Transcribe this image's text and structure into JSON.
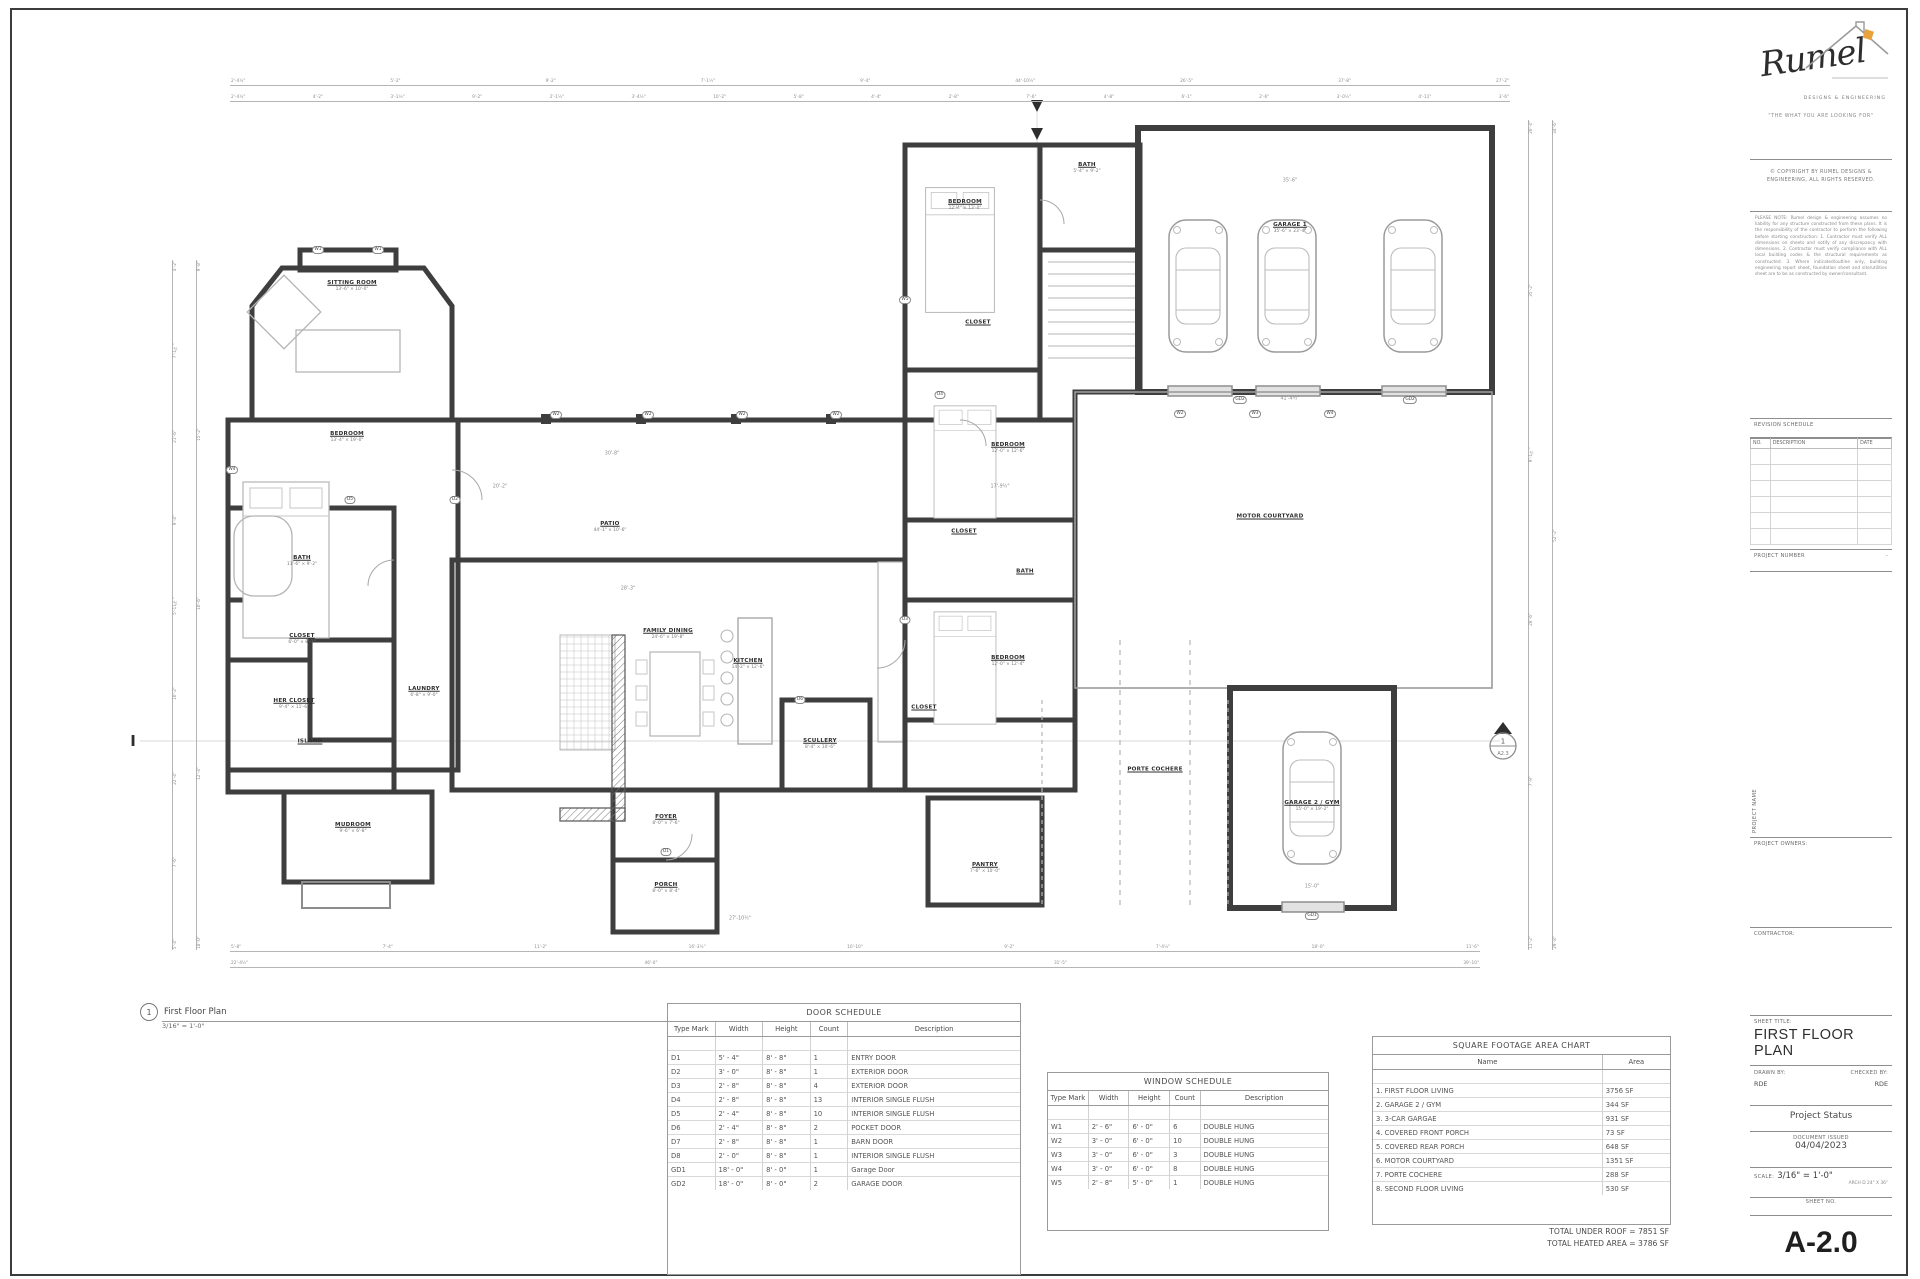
{
  "callout": {
    "number": "1",
    "title": "First Floor Plan",
    "scale": "3/16\" = 1'-0\""
  },
  "plan": {
    "room_labels": [
      {
        "n": "SITTING ROOM",
        "d": "13'-6\" × 10'-0\"",
        "x": 352,
        "y": 286
      },
      {
        "n": "BEDROOM",
        "d": "13'-4\" × 19'-0\"",
        "x": 347,
        "y": 437
      },
      {
        "n": "BATH",
        "d": "11'-6\" × 9'-2\"",
        "x": 302,
        "y": 561
      },
      {
        "n": "CLOSET",
        "d": "6'-0\" × 8'-1\"",
        "x": 302,
        "y": 639
      },
      {
        "n": "HER CLOSET",
        "d": "9'-4\" × 11'-6\"",
        "x": 294,
        "y": 704
      },
      {
        "n": "ISLAND",
        "d": "",
        "x": 310,
        "y": 742
      },
      {
        "n": "LAUNDRY",
        "d": "6'-8\" × 9'-0\"",
        "x": 424,
        "y": 692
      },
      {
        "n": "MUDROOM",
        "d": "9'-6\" × 6'-8\"",
        "x": 353,
        "y": 828
      },
      {
        "n": "PATIO",
        "d": "44'-1\" × 10'-6\"",
        "x": 610,
        "y": 527
      },
      {
        "n": "FAMILY DINING",
        "d": "24'-6\" × 19'-8\"",
        "x": 668,
        "y": 634
      },
      {
        "n": "KITCHEN",
        "d": "14'-2\" × 12'-6\"",
        "x": 748,
        "y": 664
      },
      {
        "n": "SCULLERY",
        "d": "8'-4\" × 10'-6\"",
        "x": 820,
        "y": 744
      },
      {
        "n": "FOYER",
        "d": "8'-0\" × 7'-6\"",
        "x": 666,
        "y": 820
      },
      {
        "n": "PORCH",
        "d": "8'-0\" × 8'-4\"",
        "x": 666,
        "y": 888
      },
      {
        "n": "BEDROOM",
        "d": "12'-4\" × 13'-0\"",
        "x": 965,
        "y": 205
      },
      {
        "n": "BATH",
        "d": "5'-4\" × 9'-2\"",
        "x": 1087,
        "y": 168
      },
      {
        "n": "CLOSET",
        "d": "",
        "x": 978,
        "y": 323
      },
      {
        "n": "BEDROOM",
        "d": "12'-0\" × 12'-6\"",
        "x": 1008,
        "y": 448
      },
      {
        "n": "CLOSET",
        "d": "",
        "x": 964,
        "y": 532
      },
      {
        "n": "BATH",
        "d": "",
        "x": 1025,
        "y": 572
      },
      {
        "n": "BEDROOM",
        "d": "12'-0\" × 12'-4\"",
        "x": 1008,
        "y": 661
      },
      {
        "n": "CLOSET",
        "d": "",
        "x": 924,
        "y": 708
      },
      {
        "n": "PANTRY",
        "d": "7'-6\" × 10'-0\"",
        "x": 985,
        "y": 868
      },
      {
        "n": "GARAGE 1",
        "d": "35'-6\" × 23'-4\"",
        "x": 1290,
        "y": 228
      },
      {
        "n": "MOTOR COURTYARD",
        "d": "",
        "x": 1270,
        "y": 517
      },
      {
        "n": "PORTE COCHERE",
        "d": "",
        "x": 1155,
        "y": 770
      },
      {
        "n": "GARAGE 2 / GYM",
        "d": "15'-0\" × 19'-2\"",
        "x": 1312,
        "y": 806
      }
    ],
    "tags": [
      {
        "t": "W1",
        "x": 318,
        "y": 250
      },
      {
        "t": "W1",
        "x": 378,
        "y": 250
      },
      {
        "t": "W2",
        "x": 556,
        "y": 415
      },
      {
        "t": "W2",
        "x": 648,
        "y": 415
      },
      {
        "t": "W2",
        "x": 742,
        "y": 415
      },
      {
        "t": "W2",
        "x": 836,
        "y": 415
      },
      {
        "t": "W2",
        "x": 1180,
        "y": 414
      },
      {
        "t": "W3",
        "x": 1255,
        "y": 414
      },
      {
        "t": "W4",
        "x": 1330,
        "y": 414
      },
      {
        "t": "W4",
        "x": 232,
        "y": 470
      },
      {
        "t": "W5",
        "x": 905,
        "y": 300
      },
      {
        "t": "D1",
        "x": 666,
        "y": 852
      },
      {
        "t": "D2",
        "x": 455,
        "y": 500
      },
      {
        "t": "D3",
        "x": 905,
        "y": 620
      },
      {
        "t": "D4",
        "x": 940,
        "y": 395
      },
      {
        "t": "D5",
        "x": 350,
        "y": 500
      },
      {
        "t": "D6",
        "x": 800,
        "y": 700
      },
      {
        "t": "GD2",
        "x": 1240,
        "y": 400
      },
      {
        "t": "GD2",
        "x": 1410,
        "y": 400
      },
      {
        "t": "GD1",
        "x": 1312,
        "y": 916
      },
      {
        "t": "35'-6\"",
        "x": 1290,
        "y": 182,
        "plain": true
      },
      {
        "t": "41'-4½\"",
        "x": 1290,
        "y": 400,
        "plain": true
      },
      {
        "t": "28'-3\"",
        "x": 628,
        "y": 590,
        "plain": true
      },
      {
        "t": "27'-10½\"",
        "x": 740,
        "y": 920,
        "plain": true
      },
      {
        "t": "15'-0\"",
        "x": 1312,
        "y": 888,
        "plain": true
      },
      {
        "t": "30'-8\"",
        "x": 612,
        "y": 455,
        "plain": true
      },
      {
        "t": "17'-9½\"",
        "x": 1000,
        "y": 488,
        "plain": true
      },
      {
        "t": "20'-2\"",
        "x": 500,
        "y": 488,
        "plain": true
      }
    ],
    "dims": {
      "top1": [
        "2'-4½\"",
        "5'-2\"",
        "9'-2\"",
        "7'-1½\"",
        "9'-4\"",
        "44'-10½\"",
        "26'-5\"",
        "37'-8\"",
        "27'-2\""
      ],
      "top2": [
        "2'-4½\"",
        "4'-2\"",
        "3'-1¼\"",
        "9'-2\"",
        "2'-1½\"",
        "3'-4½\"",
        "10'-2\"",
        "5'-8\"",
        "4'-4\"",
        "2'-8\"",
        "7'-6\"",
        "4'-8\"",
        "6'-1\"",
        "2'-6\"",
        "3'-0½\"",
        "4'-11\"",
        "3'-6\""
      ],
      "left1": [
        "4'-2\"",
        "7'-1½\"",
        "21'-6\"",
        "9'-4\"",
        "5'-11⅞\"",
        "10'-2\"",
        "22'-4\"",
        "7'-6\"",
        "5'-4\""
      ],
      "left2": [
        "9'-8\"",
        "15'-2\"",
        "10'-6\"",
        "12'-4\"",
        "18'-0\""
      ],
      "bottom1": [
        "5'-8\"",
        "7'-4\"",
        "11'-2\"",
        "16'-3½\"",
        "10'-10\"",
        "9'-2\"",
        "7'-4½\"",
        "18'-0\"",
        "11'-6\""
      ],
      "bottom2": [
        "22'-4½\"",
        "46'-0\"",
        "31'-5\"",
        "39'-10\""
      ],
      "right1": [
        "20'-4\"",
        "35'-2\"",
        "9'-1½\"",
        "28'-6\"",
        "7'-9\"",
        "11'-2\""
      ],
      "right2": [
        "34'-6\"",
        "52'-2\"",
        "29'-8\""
      ]
    },
    "markers": {
      "section_left": "I",
      "north_label": "A2.3"
    }
  },
  "tables": {
    "door_schedule": {
      "title": "DOOR SCHEDULE",
      "headers": [
        "Type Mark",
        "Width",
        "Height",
        "Count",
        "Description"
      ],
      "rows": [
        [
          "D1",
          "5' - 4\"",
          "8' - 8\"",
          "1",
          "ENTRY DOOR"
        ],
        [
          "D2",
          "3' - 0\"",
          "8' - 8\"",
          "1",
          "EXTERIOR DOOR"
        ],
        [
          "D3",
          "2' - 8\"",
          "8' - 8\"",
          "4",
          "EXTERIOR DOOR"
        ],
        [
          "D4",
          "2' - 8\"",
          "8' - 8\"",
          "13",
          "INTERIOR SINGLE FLUSH"
        ],
        [
          "D5",
          "2' - 4\"",
          "8' - 8\"",
          "10",
          "INTERIOR SINGLE FLUSH"
        ],
        [
          "D6",
          "2' - 4\"",
          "8' - 8\"",
          "2",
          "POCKET DOOR"
        ],
        [
          "D7",
          "2' - 8\"",
          "8' - 8\"",
          "1",
          "BARN DOOR"
        ],
        [
          "D8",
          "2' - 0\"",
          "8' - 8\"",
          "1",
          "INTERIOR SINGLE FLUSH"
        ],
        [
          "GD1",
          "18' - 0\"",
          "8' - 0\"",
          "1",
          "Garage Door"
        ],
        [
          "GD2",
          "18' - 0\"",
          "8' - 0\"",
          "2",
          "GARAGE DOOR"
        ]
      ]
    },
    "window_schedule": {
      "title": "WINDOW SCHEDULE",
      "headers": [
        "Type Mark",
        "Width",
        "Height",
        "Count",
        "Description"
      ],
      "rows": [
        [
          "W1",
          "2' - 6\"",
          "6' - 0\"",
          "6",
          "DOUBLE HUNG"
        ],
        [
          "W2",
          "3' - 0\"",
          "6' - 0\"",
          "10",
          "DOUBLE HUNG"
        ],
        [
          "W3",
          "3' - 0\"",
          "6' - 0\"",
          "3",
          "DOUBLE HUNG"
        ],
        [
          "W4",
          "3' - 0\"",
          "6' - 0\"",
          "8",
          "DOUBLE HUNG"
        ],
        [
          "W5",
          "2' - 8\"",
          "5' - 0\"",
          "1",
          "DOUBLE HUNG"
        ]
      ]
    },
    "area_chart": {
      "title": "SQUARE FOOTAGE AREA CHART",
      "headers": [
        "Name",
        "Area"
      ],
      "rows": [
        [
          "1. FIRST FLOOR LIVING",
          "3756 SF"
        ],
        [
          "2. GARAGE 2 / GYM",
          "344 SF"
        ],
        [
          "3. 3-CAR GARGAE",
          "931 SF"
        ],
        [
          "4. COVERED FRONT PORCH",
          "73 SF"
        ],
        [
          "5. COVERED REAR PORCH",
          "648 SF"
        ],
        [
          "6. MOTOR COURTYARD",
          "1351 SF"
        ],
        [
          "7. PORTE COCHERE",
          "288 SF"
        ],
        [
          "8. SECOND FLOOR LIVING",
          "530 SF"
        ]
      ],
      "totals": [
        "TOTAL UNDER ROOF = 7851 SF",
        "TOTAL HEATED AREA =  3786 SF"
      ]
    }
  },
  "titleblock": {
    "brand_script": "Rumel",
    "brand_sub": "DESIGNS & ENGINEERING",
    "tagline": "\"THE WHAT YOU ARE LOOKING FOR\"",
    "copyright_1": "© COPYRIGHT BY RUMEL DESIGNS &",
    "copyright_2": "ENGINEERING, ALL RIGHTS RESERVED.",
    "disclaimer": "PLEASE NOTE: Rumel design & engineering assumes no liability for any structure constructed from these plans. It is the responsibility of the contractor to perform the following before starting construction: 1. Contractor must verify ALL dimensions on sheets and notify of any discrepancy with dimensions. 2. Contractor must verify compliance with ALL local building codes & the structural requirements as constructed. 3. Where indicated/outline only, building engineering report sheet, foundation sheet and site/utilities sheet are to be as constructed by owner/consultant.",
    "revision": {
      "title": "REVISION SCHEDULE",
      "headers": [
        "NO.",
        "DESCRIPTION",
        "DATE"
      ],
      "empty_rows": 6
    },
    "project_number_label": "PROJECT NUMBER",
    "project_number_value": "-",
    "project_name_label": "PROJECT NAME",
    "project_owners_label": "PROJECT OWNERS:",
    "contractor_label": "CONTRACTOR:",
    "sheet_title_label": "SHEET TITLE:",
    "sheet_title": "FIRST FLOOR PLAN",
    "drawn_by_label": "DRAWN BY:",
    "drawn_by": "RDE",
    "checked_by_label": "CHECKED BY:",
    "checked_by": "RDE",
    "status": "Project Status",
    "doc_issued_label": "DOCUMENT ISSUED",
    "doc_issued_date": "04/04/2023",
    "scale_label": "SCALE:",
    "scale_value": "3/16\" = 1'-0\"",
    "sheet_size_note": "ARCH D 24\" X 36\"",
    "sheet_no_label": "SHEET NO.",
    "sheet_no": "A-2.0"
  },
  "colors": {
    "wall": "#3e3e3e",
    "light_line": "#b5b5b5",
    "accent_logo": "#e8a33d"
  }
}
